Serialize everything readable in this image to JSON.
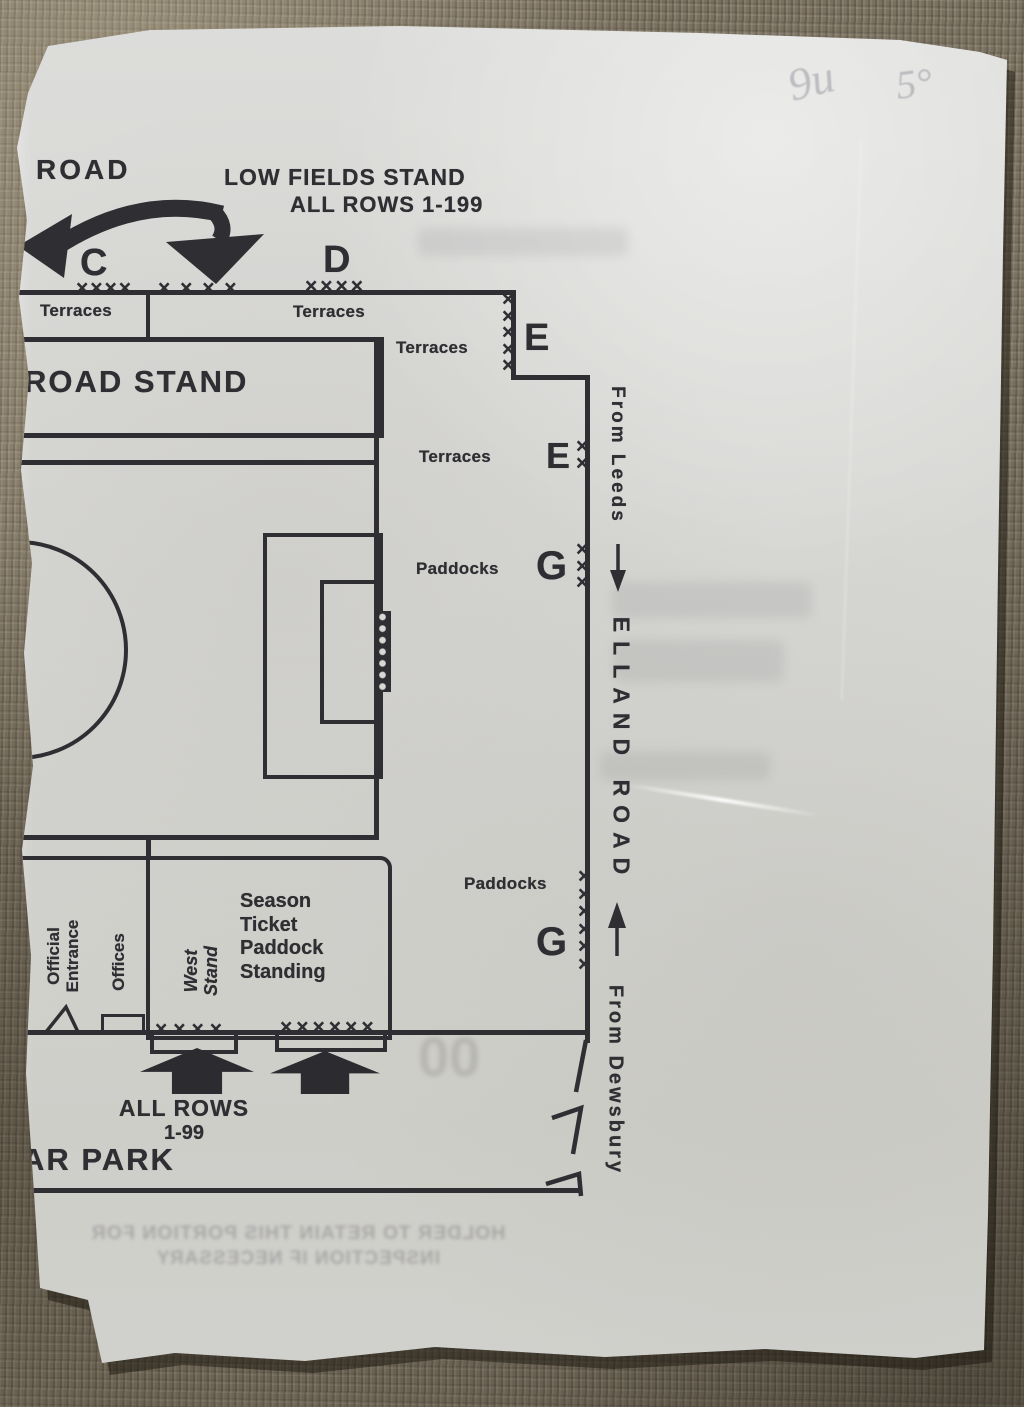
{
  "scene": {
    "handwriting": {
      "mark1": "9u",
      "mark2": "5°"
    },
    "ghost_reverse_text": {
      "line1": "HOLDER TO RETAIN THIS PORTION FOR",
      "line2": "INSPECTION IF NECESSARY",
      "serial": "00"
    },
    "colors": {
      "ink": "#2e2e33",
      "paper": "#d6d6d3",
      "fabric": "#7b7263"
    }
  },
  "plan": {
    "road_label": "ROAD",
    "low_fields": {
      "line1": "LOW FIELDS STAND",
      "line2": "ALL ROWS 1-199"
    },
    "gates": {
      "c": "C",
      "d": "D",
      "e1": "E",
      "e2": "E",
      "g1": "G",
      "g2": "G"
    },
    "terraces": {
      "t1": "Terraces",
      "t2": "Terraces",
      "t3": "Terraces",
      "t4": "Terraces"
    },
    "paddocks": {
      "p1": "Paddocks",
      "p2": "Paddocks"
    },
    "road_stand": "ROAD STAND",
    "directions": {
      "from_leeds": "From Leeds",
      "elland_road": "ELLAND ROAD",
      "from_dewsbury": "From Dewsbury"
    },
    "west_stand": "West\nStand",
    "season_ticket": "Season\nTicket\nPaddock\nStanding",
    "official_entrance": "Official\nEntrance",
    "offices": "Offices",
    "all_rows": {
      "line1": "ALL ROWS",
      "line2": "1-99"
    },
    "car_park": "AR PARK",
    "x_marks": {
      "row_c1": "××××",
      "row_c2": "× × × ×",
      "row_d": "××××",
      "col_e1": "×\n×\n×\n×\n×",
      "col_e2": "×\n×",
      "col_g1": "×\n×\n×",
      "col_g2": "×\n×\n×\n×\n×\n×",
      "row_gate1": "××××",
      "row_gate2": "××××××"
    }
  }
}
